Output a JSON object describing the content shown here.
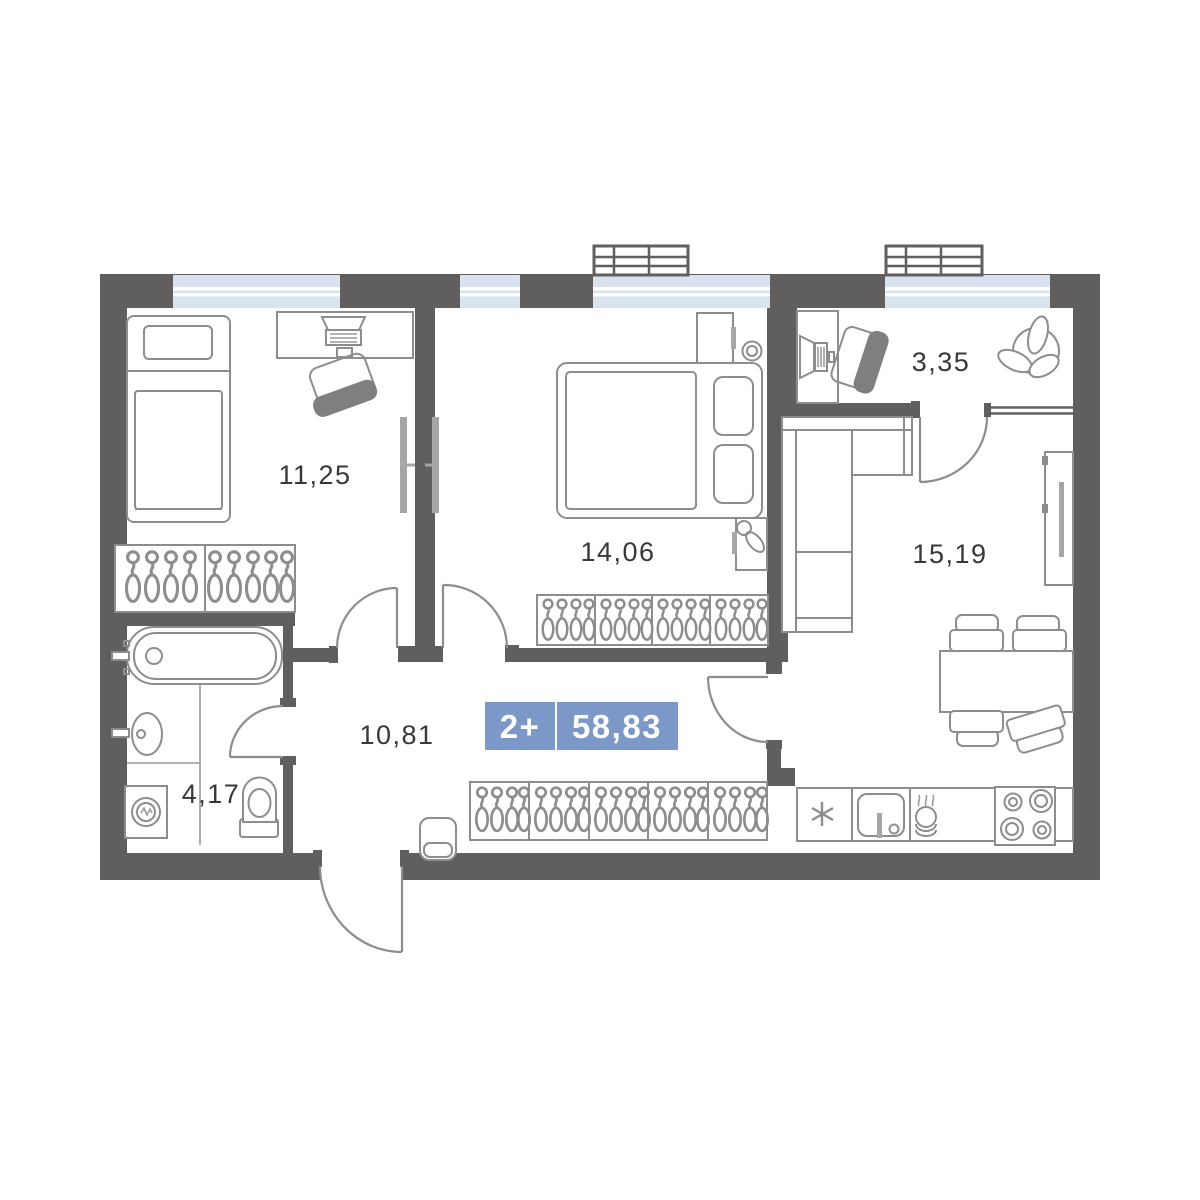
{
  "floorplan": {
    "badge": {
      "apartment_type": "2+",
      "total_area": "58,83"
    },
    "rooms": [
      {
        "name": "bedroom-1",
        "area": "11,25"
      },
      {
        "name": "bedroom-2",
        "area": "14,06"
      },
      {
        "name": "study",
        "area": "3,35"
      },
      {
        "name": "kitchen-living-room",
        "area": "15,19"
      },
      {
        "name": "hallway",
        "area": "10,81"
      },
      {
        "name": "bathroom",
        "area": "4,17"
      }
    ],
    "colors": {
      "wall": "#615F5E",
      "window_glass": "#D9E3EF",
      "furniture_line": "#8D8D8D",
      "badge_blue": "#7C98C8",
      "label_text": "#383838"
    }
  }
}
